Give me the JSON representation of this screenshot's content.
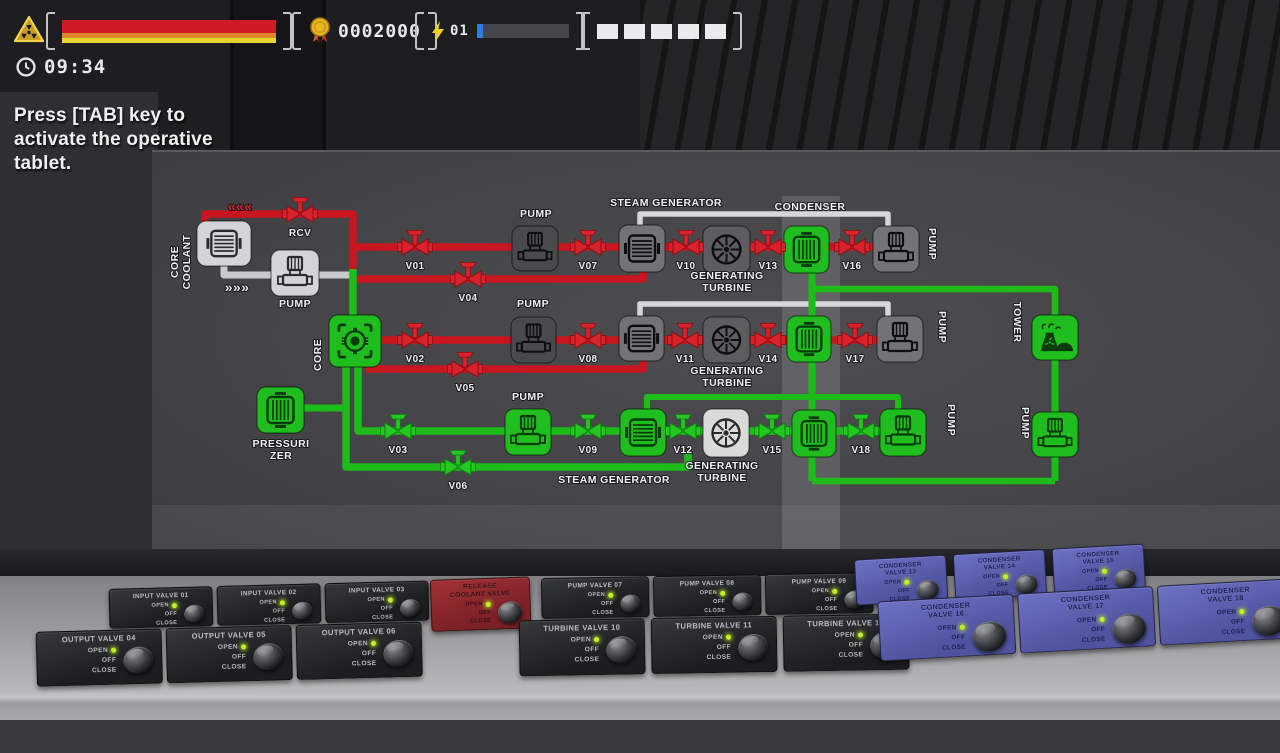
{
  "hud": {
    "warning_icon": "radiation-warning-icon",
    "health": {
      "stripe_colors": [
        "#d01a24",
        "#e0862a",
        "#e8d32e"
      ],
      "stripe_heights": [
        13,
        5,
        5
      ]
    },
    "score": {
      "icon": "medal-icon",
      "value": "0002000"
    },
    "energy": {
      "icon": "lightning-icon",
      "count": "01",
      "fill_pct": 7,
      "fill_color": "#2d7de0"
    },
    "slots": {
      "count": 5
    },
    "timer": {
      "icon": "clock-icon",
      "value": "09:34"
    },
    "tip": "Press [TAB] key to activate the operative tablet."
  },
  "diagram": {
    "palette": {
      "red": "#c8151f",
      "green": "#1dbc1b",
      "white": "#d6d7d9",
      "gray": "#c9cacc"
    },
    "node_colors": {
      "green": "#1fbd1d",
      "gray": "#737376",
      "mid": "#5d5d60",
      "dark": "#4a4a4d",
      "light": "#d3d4d6",
      "white": "#dadadb"
    },
    "pipes": [
      {
        "pts": [
          [
            224,
            264
          ],
          [
            224,
            275
          ],
          [
            353,
            275
          ]
        ],
        "c": "gray",
        "w": 7
      },
      {
        "pts": [
          [
            640,
            229
          ],
          [
            640,
            214
          ],
          [
            888,
            214
          ],
          [
            888,
            229
          ]
        ],
        "c": "white",
        "w": 5.5
      },
      {
        "pts": [
          [
            640,
            319
          ],
          [
            640,
            304
          ],
          [
            888,
            304
          ],
          [
            888,
            319
          ]
        ],
        "c": "white",
        "w": 5.5
      },
      {
        "pts": [
          [
            205,
            226
          ],
          [
            205,
            214
          ],
          [
            353,
            214
          ],
          [
            353,
            271
          ]
        ],
        "c": "red",
        "w": 7.5
      },
      {
        "pts": [
          [
            353,
            247
          ],
          [
            876,
            247
          ]
        ],
        "c": "red",
        "w": 7.5
      },
      {
        "pts": [
          [
            643,
            266
          ],
          [
            643,
            279
          ],
          [
            354,
            279
          ]
        ],
        "c": "red",
        "w": 7.5
      },
      {
        "pts": [
          [
            356,
            340
          ],
          [
            880,
            340
          ]
        ],
        "c": "red",
        "w": 7.5
      },
      {
        "pts": [
          [
            643,
            358
          ],
          [
            643,
            369
          ],
          [
            366,
            369
          ]
        ],
        "c": "red",
        "w": 7.5
      },
      {
        "pts": [
          [
            353,
            269
          ],
          [
            353,
            318
          ]
        ],
        "c": "green",
        "w": 7.5
      },
      {
        "pts": [
          [
            346,
            363
          ],
          [
            346,
            467
          ],
          [
            688,
            467
          ],
          [
            688,
            452
          ]
        ],
        "c": "green",
        "w": 7.5
      },
      {
        "pts": [
          [
            358,
            363
          ],
          [
            358,
            431
          ],
          [
            903,
            431
          ]
        ],
        "c": "green",
        "w": 7.5
      },
      {
        "pts": [
          [
            302,
            408
          ],
          [
            347,
            408
          ]
        ],
        "c": "green",
        "w": 7
      },
      {
        "pts": [
          [
            647,
            411
          ],
          [
            647,
            397
          ],
          [
            898,
            397
          ],
          [
            898,
            411
          ]
        ],
        "c": "green",
        "w": 6
      },
      {
        "pts": [
          [
            812,
            270
          ],
          [
            812,
            481
          ]
        ],
        "c": "green",
        "w": 7
      },
      {
        "pts": [
          [
            812,
            289
          ],
          [
            1055,
            289
          ],
          [
            1055,
            322
          ]
        ],
        "c": "green",
        "w": 6.5
      },
      {
        "pts": [
          [
            1055,
            357
          ],
          [
            1055,
            417
          ]
        ],
        "c": "green",
        "w": 7
      },
      {
        "pts": [
          [
            1055,
            455
          ],
          [
            1055,
            481
          ]
        ],
        "c": "green",
        "w": 7
      },
      {
        "pts": [
          [
            812,
            481
          ],
          [
            1055,
            481
          ]
        ],
        "c": "green",
        "w": 6.5
      }
    ],
    "nodes": [
      {
        "id": "core-coolant",
        "kind": "heatx-h",
        "bg": "light",
        "x": 197,
        "y": 221,
        "w": 54,
        "h": 45
      },
      {
        "id": "coolant-pump",
        "kind": "pump",
        "bg": "light",
        "x": 271,
        "y": 250,
        "w": 48,
        "h": 46
      },
      {
        "id": "core",
        "kind": "core",
        "bg": "green",
        "x": 329,
        "y": 315,
        "w": 52,
        "h": 52
      },
      {
        "id": "pressurizer",
        "kind": "heatx-v",
        "bg": "green",
        "x": 257,
        "y": 387,
        "w": 47,
        "h": 46
      },
      {
        "id": "pump-1",
        "kind": "pump",
        "bg": "dark",
        "x": 512,
        "y": 226,
        "w": 46,
        "h": 45
      },
      {
        "id": "steam-generator-1",
        "kind": "heatx-h",
        "bg": "gray",
        "x": 619,
        "y": 225,
        "w": 46,
        "h": 47
      },
      {
        "id": "turbine-1",
        "kind": "fan",
        "bg": "mid",
        "x": 703,
        "y": 226,
        "w": 47,
        "h": 47
      },
      {
        "id": "condenser-1",
        "kind": "heatx-v",
        "bg": "green",
        "x": 784,
        "y": 226,
        "w": 45,
        "h": 47
      },
      {
        "id": "pump-1b",
        "kind": "pump",
        "bg": "gray",
        "x": 873,
        "y": 226,
        "w": 46,
        "h": 46
      },
      {
        "id": "pump-2",
        "kind": "pump",
        "bg": "dark",
        "x": 511,
        "y": 317,
        "w": 45,
        "h": 46
      },
      {
        "id": "steam-generator-2",
        "kind": "heatx-h",
        "bg": "gray",
        "x": 619,
        "y": 316,
        "w": 45,
        "h": 45
      },
      {
        "id": "turbine-2",
        "kind": "fan",
        "bg": "mid",
        "x": 703,
        "y": 317,
        "w": 47,
        "h": 46
      },
      {
        "id": "condenser-2",
        "kind": "heatx-v",
        "bg": "green",
        "x": 787,
        "y": 316,
        "w": 44,
        "h": 46
      },
      {
        "id": "pump-2b",
        "kind": "pump",
        "bg": "gray",
        "x": 877,
        "y": 316,
        "w": 46,
        "h": 46
      },
      {
        "id": "tower",
        "kind": "tower",
        "bg": "green",
        "x": 1032,
        "y": 315,
        "w": 46,
        "h": 45
      },
      {
        "id": "pump-3",
        "kind": "pump",
        "bg": "green",
        "x": 505,
        "y": 409,
        "w": 46,
        "h": 46
      },
      {
        "id": "steam-generator-3",
        "kind": "heatx-h",
        "bg": "green",
        "x": 620,
        "y": 409,
        "w": 46,
        "h": 47
      },
      {
        "id": "turbine-3",
        "kind": "fan",
        "bg": "white",
        "x": 703,
        "y": 409,
        "w": 46,
        "h": 48
      },
      {
        "id": "condenser-3",
        "kind": "heatx-v",
        "bg": "green",
        "x": 792,
        "y": 410,
        "w": 44,
        "h": 47
      },
      {
        "id": "pump-3b",
        "kind": "pump",
        "bg": "green",
        "x": 880,
        "y": 409,
        "w": 46,
        "h": 47
      },
      {
        "id": "pump-right",
        "kind": "pump",
        "bg": "green",
        "x": 1032,
        "y": 412,
        "w": 46,
        "h": 45
      }
    ],
    "valves": [
      {
        "id": "RCV",
        "x": 300,
        "y": 214,
        "c": "red"
      },
      {
        "id": "V01",
        "x": 415,
        "y": 247,
        "c": "red"
      },
      {
        "id": "V04",
        "x": 468,
        "y": 279,
        "c": "red"
      },
      {
        "id": "V02",
        "x": 415,
        "y": 340,
        "c": "red"
      },
      {
        "id": "V05",
        "x": 465,
        "y": 369,
        "c": "red"
      },
      {
        "id": "V03",
        "x": 398,
        "y": 431,
        "c": "green"
      },
      {
        "id": "V06",
        "x": 458,
        "y": 467,
        "c": "green"
      },
      {
        "id": "V07",
        "x": 588,
        "y": 247,
        "c": "red"
      },
      {
        "id": "V08",
        "x": 588,
        "y": 340,
        "c": "red"
      },
      {
        "id": "V09",
        "x": 588,
        "y": 431,
        "c": "green"
      },
      {
        "id": "V10",
        "x": 686,
        "y": 247,
        "c": "red"
      },
      {
        "id": "V11",
        "x": 685,
        "y": 340,
        "c": "red"
      },
      {
        "id": "V12",
        "x": 683,
        "y": 431,
        "c": "green"
      },
      {
        "id": "V13",
        "x": 768,
        "y": 247,
        "c": "red"
      },
      {
        "id": "V14",
        "x": 768,
        "y": 340,
        "c": "red"
      },
      {
        "id": "V15",
        "x": 772,
        "y": 431,
        "c": "green"
      },
      {
        "id": "V16",
        "x": 852,
        "y": 247,
        "c": "red"
      },
      {
        "id": "V17",
        "x": 855,
        "y": 340,
        "c": "red"
      },
      {
        "id": "V18",
        "x": 861,
        "y": 431,
        "c": "green"
      }
    ],
    "labels": [
      {
        "t": [
          "CORE",
          "COOLANT"
        ],
        "x": 178,
        "y": 262,
        "rot": -90
      },
      {
        "t": "PUMP",
        "x": 295,
        "y": 307
      },
      {
        "t": "CORE",
        "x": 321,
        "y": 355,
        "rot": -90
      },
      {
        "t": [
          "PRESSURI",
          "ZER"
        ],
        "x": 281,
        "y": 447
      },
      {
        "t": "PUMP",
        "x": 536,
        "y": 217
      },
      {
        "t": "PUMP",
        "x": 533,
        "y": 307
      },
      {
        "t": "PUMP",
        "x": 528,
        "y": 400
      },
      {
        "t": "STEAM GENERATOR",
        "x": 666,
        "y": 206
      },
      {
        "t": "STEAM GENERATOR",
        "x": 614,
        "y": 483
      },
      {
        "t": "CONDENSER",
        "x": 810,
        "y": 210
      },
      {
        "t": [
          "GENERATING",
          "TURBINE"
        ],
        "x": 727,
        "y": 279
      },
      {
        "t": [
          "GENERATING",
          "TURBINE"
        ],
        "x": 727,
        "y": 374
      },
      {
        "t": [
          "GENERATING",
          "TURBINE"
        ],
        "x": 722,
        "y": 469
      },
      {
        "t": "PUMP",
        "x": 929,
        "y": 244,
        "rot": 90
      },
      {
        "t": "PUMP",
        "x": 939,
        "y": 327,
        "rot": 90
      },
      {
        "t": "PUMP",
        "x": 948,
        "y": 420,
        "rot": 90
      },
      {
        "t": "PUMP",
        "x": 1022,
        "y": 423,
        "rot": 90
      },
      {
        "t": "TOWER",
        "x": 1014,
        "y": 322,
        "rot": 90
      },
      {
        "t": "«««",
        "x": 240,
        "y": 211,
        "s": 14,
        "c": "#d8232c"
      },
      {
        "t": "»»»",
        "x": 237,
        "y": 292,
        "s": 14,
        "c": "#e9e9eb"
      }
    ]
  },
  "console": {
    "knob_labels": {
      "open": "OPEN",
      "off": "OFF",
      "close": "CLOSE"
    },
    "groups": [
      {
        "id": "left",
        "theme": "dark",
        "rows": [
          [
            "INPUT VALVE 01",
            "INPUT VALVE 02",
            "INPUT VALVE 03"
          ],
          [
            "OUTPUT VALVE 04",
            "OUTPUT VALVE 05",
            "OUTPUT VALVE 06"
          ]
        ]
      },
      {
        "id": "release",
        "theme": "red",
        "rows": [
          [
            "RELEASE\nCOOLANT VALVE"
          ]
        ]
      },
      {
        "id": "mid",
        "theme": "dark",
        "rows": [
          [
            "PUMP VALVE 07",
            "PUMP VALVE 08",
            "PUMP VALVE 09"
          ],
          [
            "TURBINE VALVE 10",
            "TURBINE VALVE 11",
            "TURBINE VALVE 12"
          ]
        ]
      },
      {
        "id": "right",
        "theme": "blue",
        "rows": [
          [
            "CONDENSER\nVALVE 13",
            "CONDENSER\nVALVE 14",
            "CONDENSER\nVALVE 15"
          ],
          [
            "CONDENSER\nVALVE 16",
            "CONDENSER\nVALVE 17",
            "CONDENSER\nVALVE 18"
          ]
        ]
      }
    ]
  }
}
